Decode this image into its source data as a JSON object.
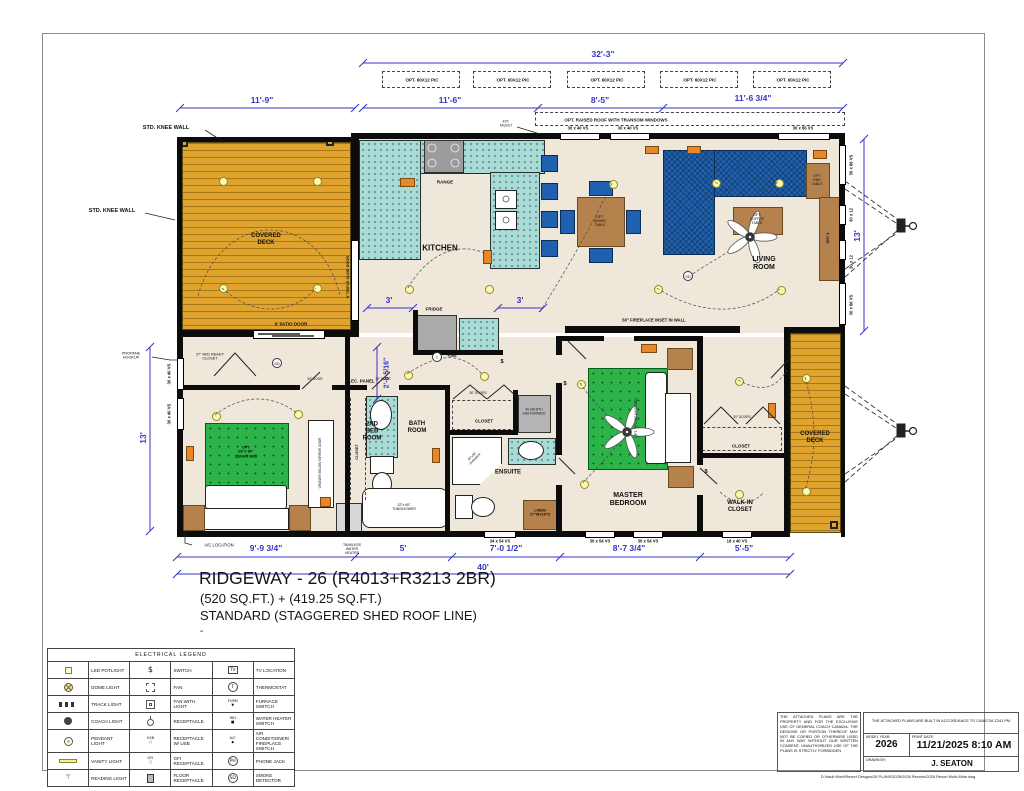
{
  "title": {
    "line1": "RIDGEWAY - 26 (R4013+R3213 2BR)",
    "line2": "(520 SQ.FT.) + (419.25 SQ.FT.)",
    "line3": "STANDARD (STAGGERED SHED ROOF LINE)",
    "line4": "-"
  },
  "colors": {
    "dimension_blue": "#3434C6",
    "deck_wood": "#E0A42E",
    "counter_teal": "#A9DAD5",
    "sofa_blue": "#1F61AE",
    "bed_green": "#2CB34A",
    "furniture_wood": "#B5824E",
    "marker_orange": "#E8862A"
  },
  "plan": {
    "dims": {
      "top_overall": "32'-3\"",
      "deck_width": "11'-9\"",
      "seg_a": "11'-6\"",
      "seg_b": "8'-5\"",
      "seg_c": "11'-6 3/4\"",
      "left_height": "13'",
      "right_height": "13'",
      "k3a": "3'",
      "k3b": "3'",
      "hall": "2'-8 5/16\"",
      "b1": "9'-9 3/4\"",
      "b2": "5'",
      "b3": "7'-0 1/2\"",
      "b4": "8'-7 3/4\"",
      "b5": "5'-5\"",
      "bottom_overall": "40'"
    },
    "options": {
      "pic": "OPT. 60X12 PIC",
      "raised_roof": "OPT. RAISED ROOF WITH TRANSOM WINDOWS"
    },
    "windows": {
      "t1": "30 x 40 VS",
      "t2": "30 x 40 VS",
      "t3": "30 x 66 VS",
      "r1": "30 x 66 VS",
      "r2": "30 x 12",
      "r3": "30 x 12",
      "r4": "30 x 66 VS",
      "l1": "30 x 40 VS",
      "l2": "30 x 40 VS",
      "bb1": "34 x 54 VS",
      "bb2": "30 x 54 VS",
      "bb3": "30 x 54 VS",
      "bb4": "18 x 40 VS"
    },
    "doors": {
      "patio": "6' PATIO DOOR",
      "slide": "9' TRIPLE SLIDE DOOR",
      "hall_closet": "36\" DOORS",
      "master_closet": "30\" DOORS",
      "d30": "30\" DOOR"
    },
    "rooms": {
      "kitchen": "KITCHEN",
      "living": "LIVING\nROOM",
      "bed2": "2ND\nBED\nROOM",
      "bath": "BATH\nROOM",
      "ensuite": "ENSUITE",
      "master": "MASTER\nBEDROOM",
      "walkin": "WALK-IN\nCLOSET",
      "closet_hall": "CLOSET",
      "closet_master": "CLOSET",
      "closet_bed2": "CLOSET",
      "deck_left": "COVERED\nDECK",
      "deck_right": "COVERED\nDECK",
      "wd_closet": "27\" W/D READY\nCLOSET",
      "linen": "LINEN\n27\"Wx18\"D"
    },
    "fixtures": {
      "range": "RANGE",
      "fridge": "FRIDGE",
      "dining": "OPT.\nDINING\nTABLE",
      "coffee": "OPT.\nCOFFEE\nTABLE",
      "end_table": "OPT.\nEND\nTABLE",
      "ent": "ENT 4",
      "queen": "OPT.\n60\"x 80\"\nQUEEN BED",
      "king": "OPT. 76\"x 80\" KING BED",
      "tub": "32\"x 60\"\nTUB/SHOWER",
      "shower": "36\"x36\"\nSHOWER",
      "furnace": "40,000 BTU\nGAS FURNACE",
      "tankless": "TANKLESS\nWATER\nHEATER",
      "wardrobe": "DRAWER BELOW MIRROR DOOR"
    },
    "notes": {
      "knee1": "STD. KNEE WALL",
      "knee2": "STD. KNEE WALL",
      "propane": "PROPANE\nHOOKUP",
      "ac": "A/C LOCATION",
      "faucet": "EXT.\nFAUCET",
      "fireplace": "50\" FIREPLACE INSET IN WALL",
      "panel": "ELEC. PANEL",
      "sd": "SD",
      "therm": "T",
      "furn": "FURN",
      "sw": "$"
    }
  },
  "legend": {
    "title": "ELECTRICAL LEGEND",
    "rows": [
      {
        "i1": "led-potlight",
        "t1": "LED POTLIGHT",
        "i2": "switch",
        "t2": "SWITCH",
        "i3": "tv-location",
        "t3": "TV LOCATION"
      },
      {
        "i1": "dome-light",
        "t1": "DOME LIGHT",
        "i2": "fan",
        "t2": "FAN",
        "i3": "thermostat",
        "t3": "THERMOSTAT"
      },
      {
        "i1": "track-light",
        "t1": "TRACK LIGHT",
        "i2": "fan-with-light",
        "t2": "FAN WITH LIGHT",
        "i3": "furnace-switch",
        "t3": "FURNACE SWITCH"
      },
      {
        "i1": "coach-light",
        "t1": "COACH LIGHT",
        "i2": "receptacle",
        "t2": "RECEPTACLE",
        "i3": "water-heater-switch",
        "t3": "WATER HEATER SWITCH"
      },
      {
        "i1": "pendant-light",
        "t1": "PENDANT LIGHT",
        "i2": "receptacle-usb",
        "t2": "RECEPTACLE W/ USB",
        "i3": "ac-fireplace-switch",
        "t3": "AIR CONDITIONER/ FIREPLACE SWITCH"
      },
      {
        "i1": "vanity-light",
        "t1": "VANITY LIGHT",
        "i2": "gfi-receptacle",
        "t2": "GFI RECEPTACLE",
        "i3": "phone-jack",
        "t3": "PHONE JACK"
      },
      {
        "i1": "reading-light",
        "t1": "READING LIGHT",
        "i2": "floor-receptacle",
        "t2": "FLOOR RECEPTACLE",
        "i3": "smoke-detector",
        "t3": "SMOKE DETECTOR"
      }
    ]
  },
  "info": {
    "copyright": "THE ATTACHED PLANS ARE THE PROPERTY AND FOR THE EXCLUSIVE USE OF GENERAL COACH CANADA. THE DESIGNS OR PORTION THEREOF MAY NOT BE COPIED OR OTHERWISE USED IN ANY WAY WITHOUT OUR WRITTEN CONSENT. UNAUTHORIZED USE OF THE PLANS IS STRICTLY FORBIDDEN",
    "compliance": "THE ATTACHED PLANS ARE BUILT IN ACCORDANCE TO CAN/CSA Z241 PM",
    "model_year_label": "MODEL YEAR:",
    "model_year": "2026",
    "print_date_label": "PRINT DATE:",
    "print_date": "11/21/2025 8:10 AM",
    "drawn_by_label": "DRAWN BY:",
    "drawn_by": "J. SEATON",
    "file_path": "D:\\Vault Work\\Resort Designs\\26 PLANS\\2026\\2026 Resorts\\2026 Resort Multi-Wide.dwg"
  }
}
